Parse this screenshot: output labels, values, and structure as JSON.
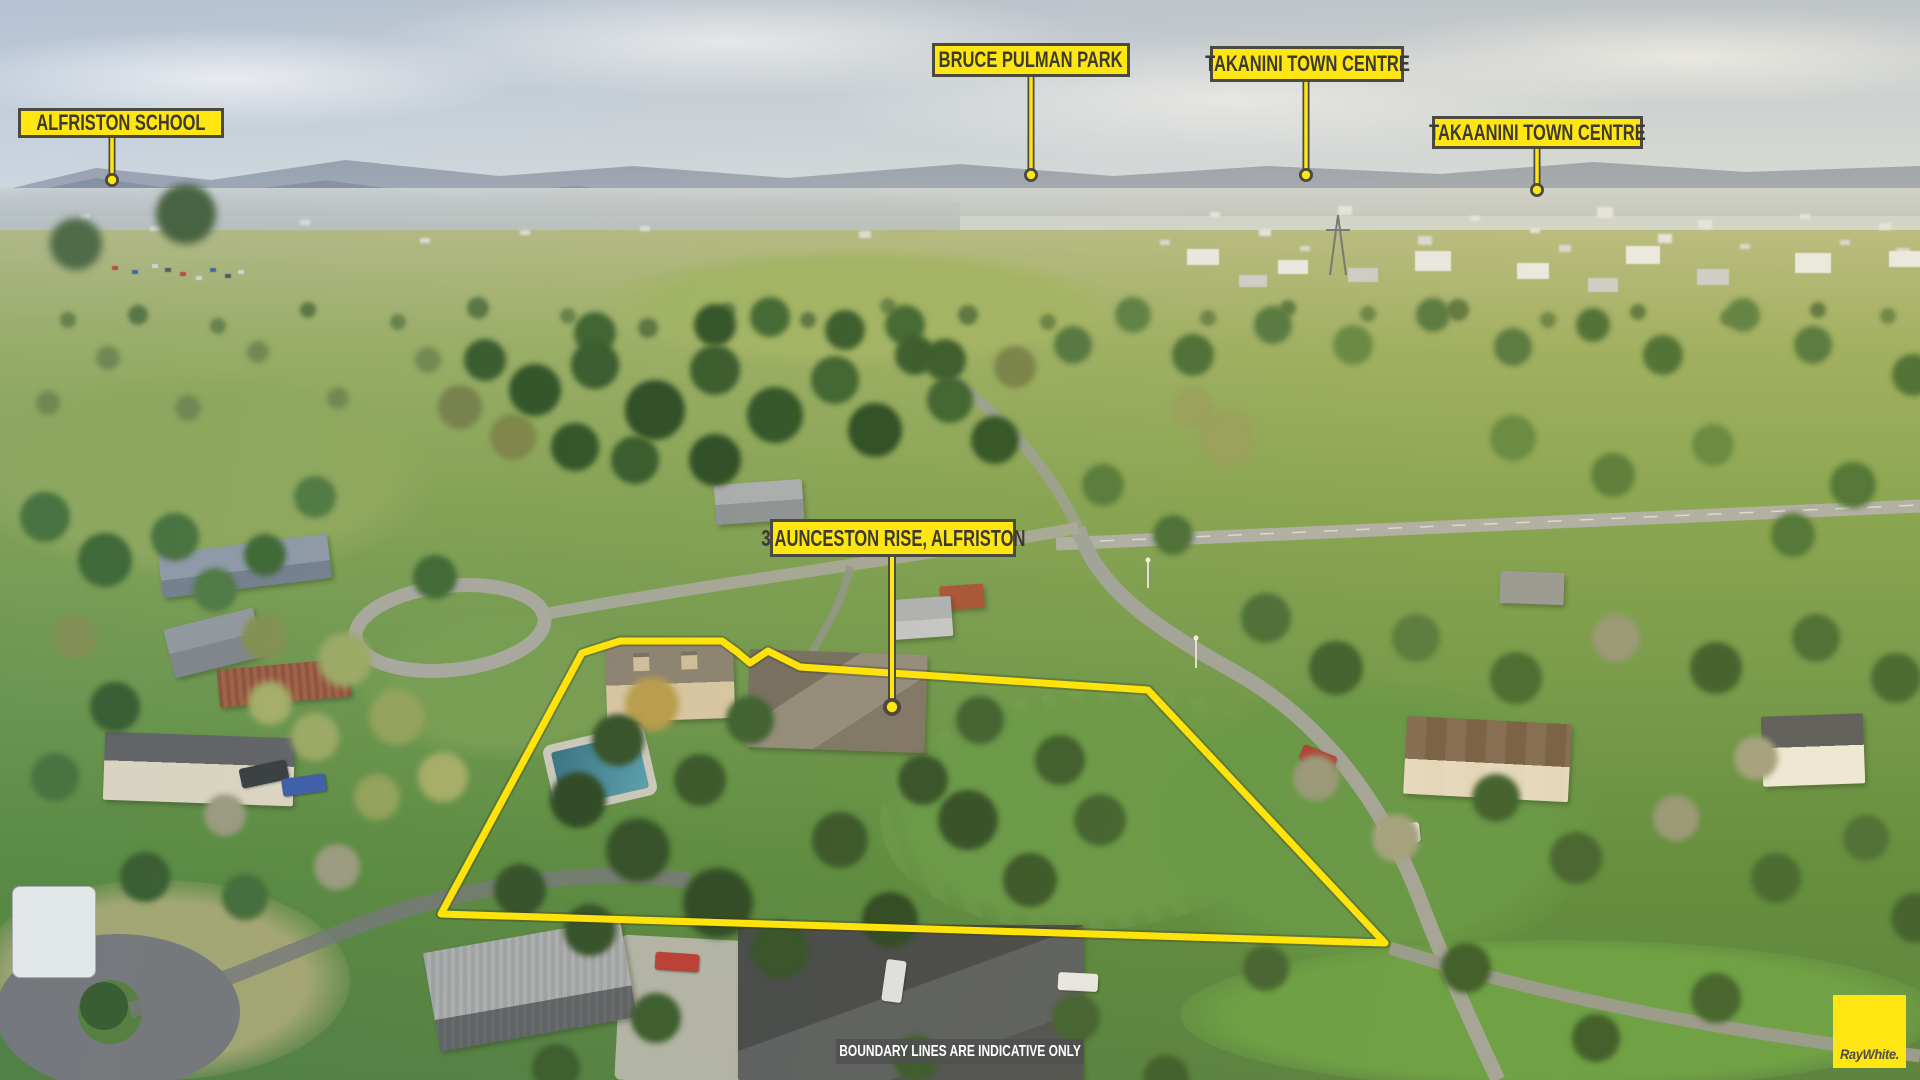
{
  "photo": {
    "location_labels": [
      {
        "id": "alfriston-school",
        "text": "ALFRISTON SCHOOL"
      },
      {
        "id": "bruce-pulman-park",
        "text": "BRUCE PULMAN PARK"
      },
      {
        "id": "takanini-town-centre",
        "text": "TAKANINI TOWN CENTRE"
      },
      {
        "id": "takaanini-town-centre",
        "text": "TAKAANINI TOWN CENTRE"
      }
    ],
    "property_label": {
      "text": "3 AUNCESTON RISE, ALFRISTON"
    },
    "disclaimer": "BOUNDARY LINES ARE INDICATIVE ONLY",
    "brand": "RayWhite.",
    "colors": {
      "sign_yellow": "#FFE512",
      "sign_border": "#4A4A40",
      "sign_text": "#3C3B33",
      "boundary_yellow": "#FFE30B",
      "disclaimer_bg": "#4F4F4F",
      "disclaimer_text": "#FFFFFF",
      "logo_yellow": "#FFE512",
      "logo_text_color": "#4F4E49"
    }
  }
}
